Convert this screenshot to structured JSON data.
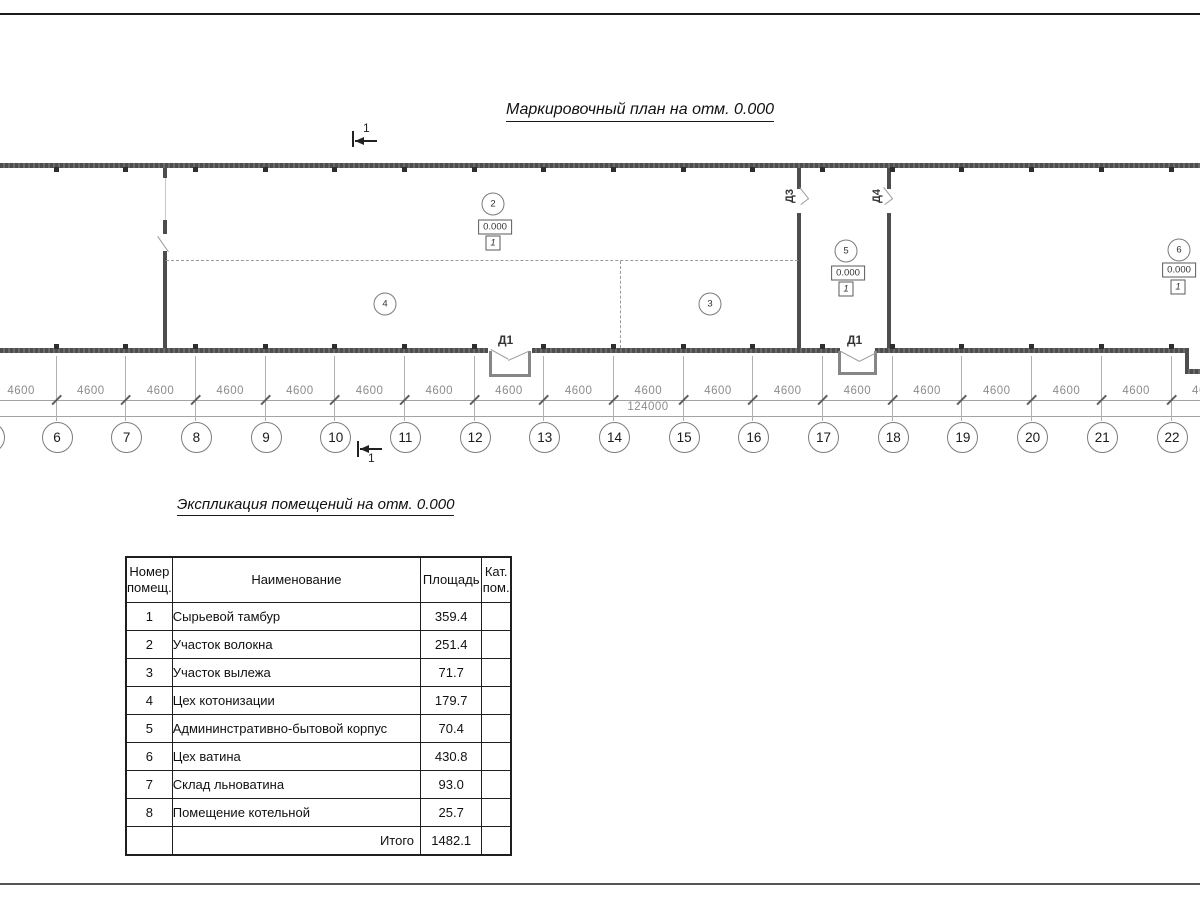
{
  "drawing": {
    "plan_title": "Маркировочный план на отм. 0.000",
    "section_label": "1",
    "rooms": [
      {
        "number": "2",
        "elevation": "0.000",
        "floor_type": "1"
      },
      {
        "number": "4"
      },
      {
        "number": "3"
      },
      {
        "number": "5",
        "elevation": "0.000",
        "floor_type": "1"
      },
      {
        "number": "6",
        "elevation": "0.000",
        "floor_type": "1"
      }
    ],
    "doors": [
      {
        "label": "Д1"
      },
      {
        "label": "Д1"
      },
      {
        "label": "Д3"
      },
      {
        "label": "Д4"
      }
    ]
  },
  "dims": {
    "bay": "4600",
    "total": "124000",
    "axes": [
      "6",
      "7",
      "8",
      "9",
      "10",
      "11",
      "12",
      "13",
      "14",
      "15",
      "16",
      "17",
      "18",
      "19",
      "20",
      "21",
      "22"
    ]
  },
  "table": {
    "title": "Экспликация помещений на отм. 0.000",
    "headers": {
      "num": "Номер помещ.",
      "name": "Наименование",
      "area": "Площадь",
      "cat": "Кат. пом."
    },
    "rows": [
      {
        "num": "1",
        "name": "Сырьевой тамбур",
        "area": "359.4",
        "cat": ""
      },
      {
        "num": "2",
        "name": "Участок волокна",
        "area": "251.4",
        "cat": ""
      },
      {
        "num": "3",
        "name": "Участок вылежа",
        "area": "71.7",
        "cat": ""
      },
      {
        "num": "4",
        "name": "Цех котонизации",
        "area": "179.7",
        "cat": ""
      },
      {
        "num": "5",
        "name": "Админинстративно-бытовой корпус",
        "area": "70.4",
        "cat": ""
      },
      {
        "num": "6",
        "name": "Цех ватина",
        "area": "430.8",
        "cat": ""
      },
      {
        "num": "7",
        "name": "Склад льноватина",
        "area": "93.0",
        "cat": ""
      },
      {
        "num": "8",
        "name": "Помещение котельной",
        "area": "25.7",
        "cat": ""
      }
    ],
    "total_label": "Итого",
    "total_value": "1482.1"
  }
}
